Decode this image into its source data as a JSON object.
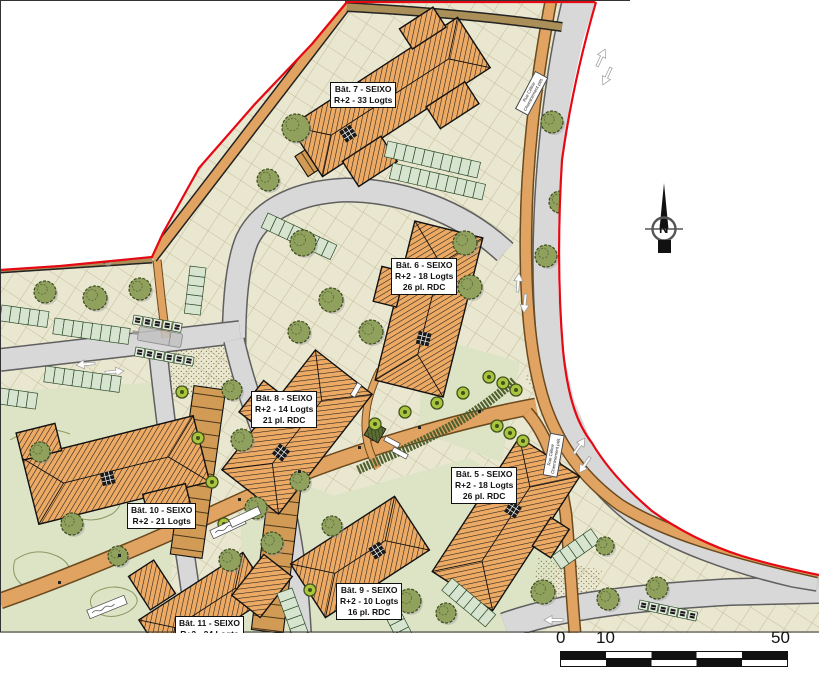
{
  "buildings": [
    {
      "id": "bat-7",
      "lines": [
        "Bât. 7 - SEIXO",
        "R+2 - 33 Logts"
      ]
    },
    {
      "id": "bat-6",
      "lines": [
        "Bât. 6 - SEIXO",
        "R+2 - 18 Logts",
        "26 pl. RDC"
      ]
    },
    {
      "id": "bat-8",
      "lines": [
        "Bât. 8 - SEIXO",
        "R+2 - 14 Logts",
        "21 pl. RDC"
      ]
    },
    {
      "id": "bat-5",
      "lines": [
        "Bât. 5 - SEIXO",
        "R+2 - 18 Logts",
        "26 pl. RDC"
      ]
    },
    {
      "id": "bat-10",
      "lines": [
        "Bât. 10 - SEIXO",
        "R+2 - 21 Logts"
      ]
    },
    {
      "id": "bat-9",
      "lines": [
        "Bât. 9 - SEIXO",
        "R+2 - 10 Logts",
        "16 pl. RDC"
      ]
    },
    {
      "id": "bat-11",
      "lines": [
        "Bât. 11 - SEIXO",
        "R+2 - 24 Logts"
      ]
    }
  ],
  "road_labels": [
    {
      "line1": "Rue Céline",
      "line2": "Cheminement piét."
    },
    {
      "line1": "Rue Céline",
      "line2": "Cheminement piét."
    }
  ],
  "north_arrow": {
    "letter": "N"
  },
  "scale_bar": {
    "labels": [
      "0",
      "10",
      "50"
    ]
  },
  "colors": {
    "boundary_red": "#e60914",
    "building_orange": "#ecaa64",
    "road_gray": "#d8d8d8",
    "path_orange": "#e0a361",
    "plaza_khaki": "#eae7d0",
    "lawn_green": "#dde3c5",
    "stall_green": "#d7e4d0",
    "garage_tan": "#d19a55",
    "tree_olive": "#76883e",
    "tree_lime": "#a9c43d",
    "brown_path": "#ab8f58",
    "grid_line": "#b8b08a"
  }
}
